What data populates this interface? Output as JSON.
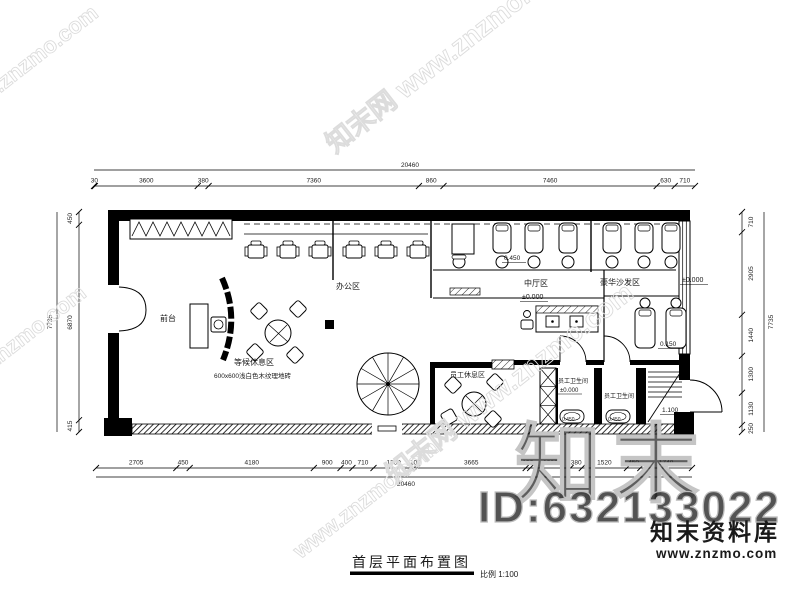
{
  "title_block": {
    "title": "首层平面布置图",
    "scale": "比例 1:100"
  },
  "branding": {
    "site_name": "知末资料库",
    "site_url": "www.znzmo.com",
    "id_text": "ID:632133022",
    "big_mark": "知末"
  },
  "watermarks": {
    "full": "知末网 www.znzmo.com",
    "url": "www.znzmo.com"
  },
  "plan": {
    "dims": {
      "top": [
        "30",
        "3600",
        "380",
        "7360",
        "860",
        "7460",
        "630",
        "710"
      ],
      "top_total": "20460",
      "bottom": [
        "2705",
        "450",
        "4180",
        "900",
        "400",
        "710",
        "1360",
        "100",
        "3665",
        "150",
        "1360",
        "380",
        "1520",
        "450",
        "1740"
      ],
      "bottom_total": "20460",
      "left": [
        "450",
        "6870",
        "415"
      ],
      "left_total": "7735",
      "right": [
        "710",
        "2905",
        "1440",
        "1300",
        "1130",
        "250"
      ],
      "right_total": "7735"
    },
    "labels": {
      "office_area": "办公区",
      "hall_area": "中厅区",
      "hall_level": "±0.000",
      "sofa_area": "豪华沙发区",
      "sofa_level": "±0.000",
      "bed_level": "0.450",
      "lower_bed_level": "0.150",
      "front_desk": "前台",
      "waiting_area": "等候休息区",
      "floor_note": "600x600浅白色木纹理地砖",
      "staff_lounge": "员工休息区",
      "staff_toilet_1": "员工卫生间",
      "staff_toilet_1_level": "±0.000",
      "staff_toilet_2": "员工卫生间",
      "stair_level": "1.100",
      "tub_level_1": "0.450",
      "tub_level_2": "0.450"
    }
  }
}
